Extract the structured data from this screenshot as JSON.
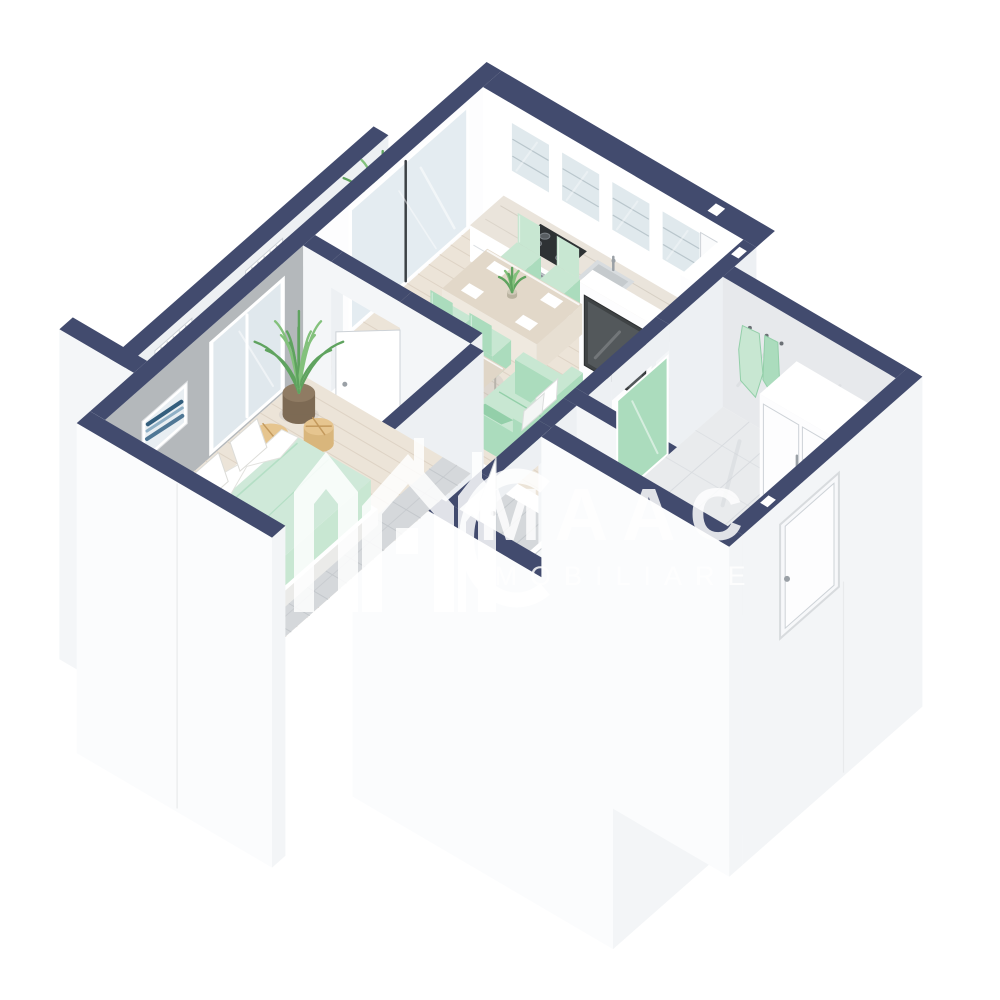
{
  "watermark": {
    "title": "MAAC",
    "subtitle": "IMOBILIARE",
    "logo": "maac-houses-logo"
  },
  "palette": {
    "background": "#ffffff",
    "navy": "#424b6e",
    "navy_edge": "#39415c",
    "wall_white": "#ffffff",
    "face_sw": "#f4f6f8",
    "face_se": "#edf0f3",
    "skirt_sw": "#fbfcfd",
    "skirt_se": "#f3f5f7",
    "gray_wall": "#b4b8bb",
    "wood": "#ece4d8",
    "wood_line": "#ded3c5",
    "gray_plank": "#d5d8db",
    "gray_plank_line": "#c4c8cc",
    "tile": "#edeff1",
    "tile_line": "#dee2e5",
    "marble": "#e9ebed",
    "marble_line": "#d9dce0",
    "balcony": "#d8dbde",
    "balcony_line": "#c9cdd1",
    "mint": "#c8e7d2",
    "mint_dark": "#abdcbd",
    "mint_deep": "#93cfa9",
    "tv": "#3f4345",
    "steel": "#c2c7cc",
    "steel_dark": "#54585c",
    "counter": "#eae4db",
    "counter_line": "#d6cfc4",
    "glass": "rgba(205,220,229,0.55)",
    "glass_solid": "#dde6eb",
    "line": "#cdd2d7",
    "plant": "#83c17c",
    "plant_dark": "#5fa35f",
    "stool": "#d9b67c",
    "pot": "#7d6a54",
    "art_blue": "#4f7795",
    "art_blue2": "#8fb0c6",
    "shadow": "rgba(100,110,125,0.10)"
  },
  "scene": {
    "type": "isometric-3d-apartment-floor-plan",
    "style": "cutaway render, navy wall tops, white walls",
    "rooms": [
      {
        "name": "balcony",
        "items": [
          "parapet wall",
          "radiator",
          "radiator",
          "potted plant"
        ]
      },
      {
        "name": "kitchen",
        "items": [
          "glass upper cabinets",
          "counter",
          "gas cooktop",
          "oven",
          "sink",
          "tall cabinet"
        ]
      },
      {
        "name": "dining area",
        "items": [
          "wood dining table",
          "4 mint chairs",
          "4 place settings",
          "plant centerpiece"
        ]
      },
      {
        "name": "living area",
        "items": [
          "mint sofa with white pillows",
          "coffee table with plant and book",
          "wall-mounted tv",
          "media wall"
        ]
      },
      {
        "name": "bedroom",
        "items": [
          "double bed with mint bedding",
          "white pillows",
          "gray accent wall",
          "framed wave artwork",
          "potted plant",
          "two wooden stools",
          "sliding glass door"
        ]
      },
      {
        "name": "bathroom",
        "items": [
          "bathtub with glass screen",
          "toilet",
          "open white door",
          "green towel"
        ]
      },
      {
        "name": "hallway",
        "items": [
          "white wardrobe",
          "coat hooks with green jacket",
          "mint mirror",
          "marble tile floor",
          "entry door"
        ]
      }
    ]
  }
}
